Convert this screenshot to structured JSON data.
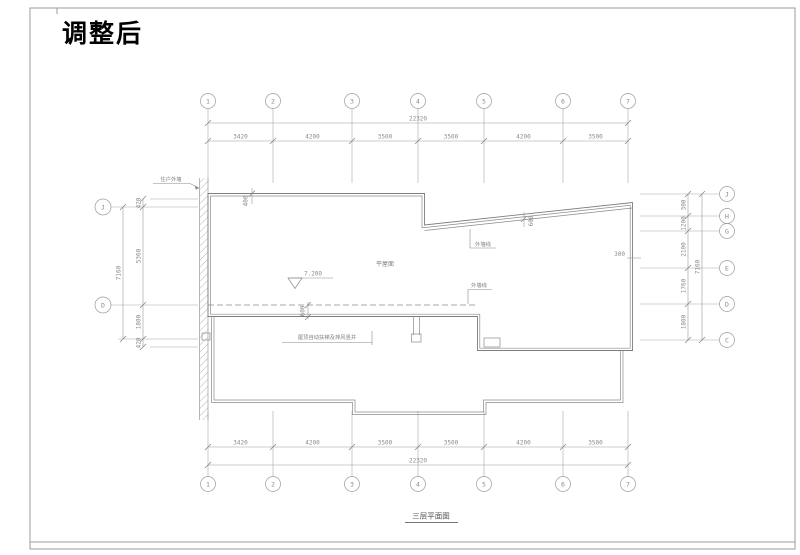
{
  "sheet": {
    "title": "调整后",
    "caption": "三层平面图"
  },
  "grid": {
    "top": {
      "bubbles": [
        "1",
        "2",
        "3",
        "4",
        "5",
        "6",
        "7"
      ],
      "segments": [
        "3420",
        "4200",
        "3500",
        "3500",
        "4200",
        "3500"
      ],
      "overall": "22320"
    },
    "bottom": {
      "bubbles": [
        "1",
        "2",
        "3",
        "4",
        "5",
        "6",
        "7"
      ],
      "segments": [
        "3420",
        "4200",
        "3500",
        "3500",
        "4200",
        "3500"
      ],
      "overall": "22320"
    },
    "left": {
      "bubbles": [
        "J",
        "D"
      ],
      "segments": [
        "420",
        "5360",
        "1800",
        "420"
      ],
      "overall": "7160"
    },
    "right": {
      "bubbles": [
        "J",
        "H",
        "G",
        "E",
        "D",
        "C"
      ],
      "segments": [
        "300",
        "1200",
        "2100",
        "1760",
        "1800"
      ],
      "overall": "7160"
    }
  },
  "plan": {
    "elevation": "7.200",
    "roof_label": "平屋面",
    "wall_label": "住户外墙",
    "wall_line_label_1": "外墙线",
    "wall_line_label_2": "外墙线",
    "shaft_note": "屋顶自动扶梯及排风竖井",
    "dims": {
      "top_offset": "400",
      "roof_band": "600",
      "eave": "600",
      "parapet": "300"
    }
  }
}
